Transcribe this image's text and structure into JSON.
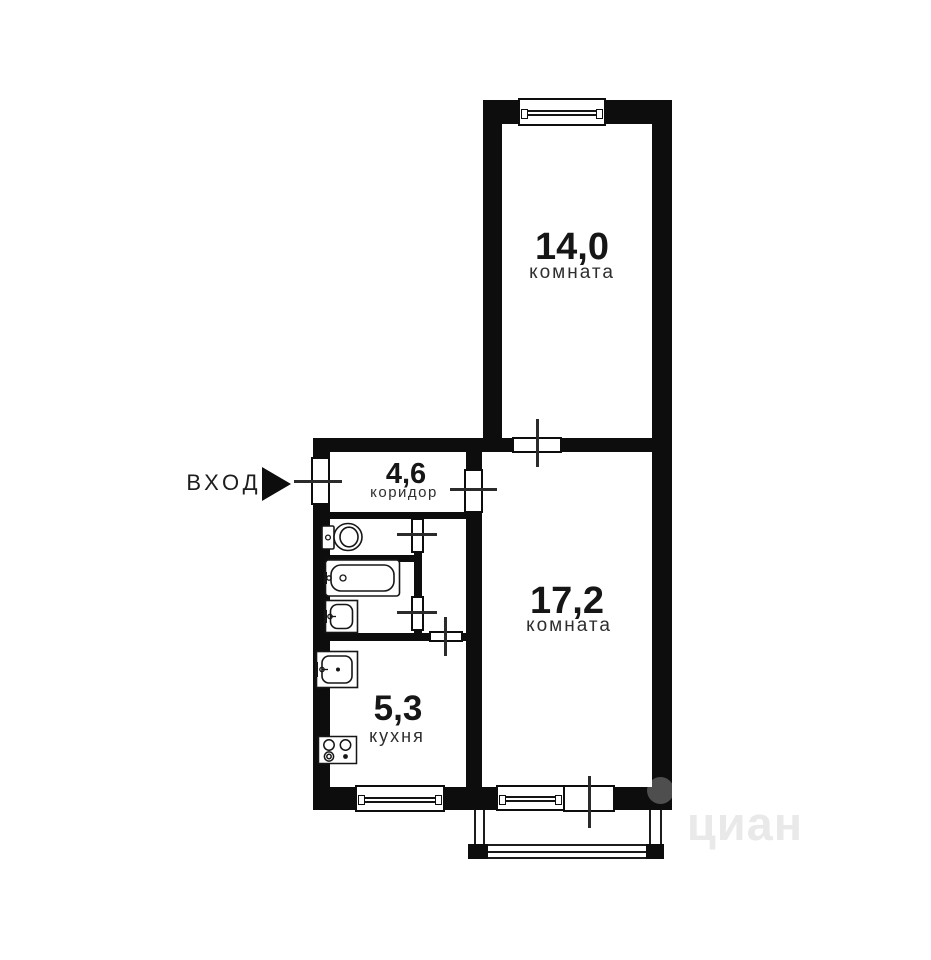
{
  "plan_title": "apartment-floor-plan",
  "rooms": {
    "room1": {
      "area": "14,0",
      "type": "комната"
    },
    "room2": {
      "area": "17,2",
      "type": "комната"
    },
    "corridor": {
      "area": "4,6",
      "type": "коридор"
    },
    "kitchen": {
      "area": "5,3",
      "type": "кухня"
    }
  },
  "entrance": {
    "label": "ВХОД"
  },
  "watermark": {
    "text": "циан"
  },
  "fixtures": [
    "toilet-icon",
    "bathtub-icon",
    "bath-sink-icon",
    "kitchen-sink-icon",
    "stove-icon"
  ],
  "colors": {
    "wall": "#0d0d0d",
    "background": "#ffffff",
    "area_text": "#161616",
    "room_type_text": "#2e2e2e",
    "watermark": "#e9e9e9"
  }
}
